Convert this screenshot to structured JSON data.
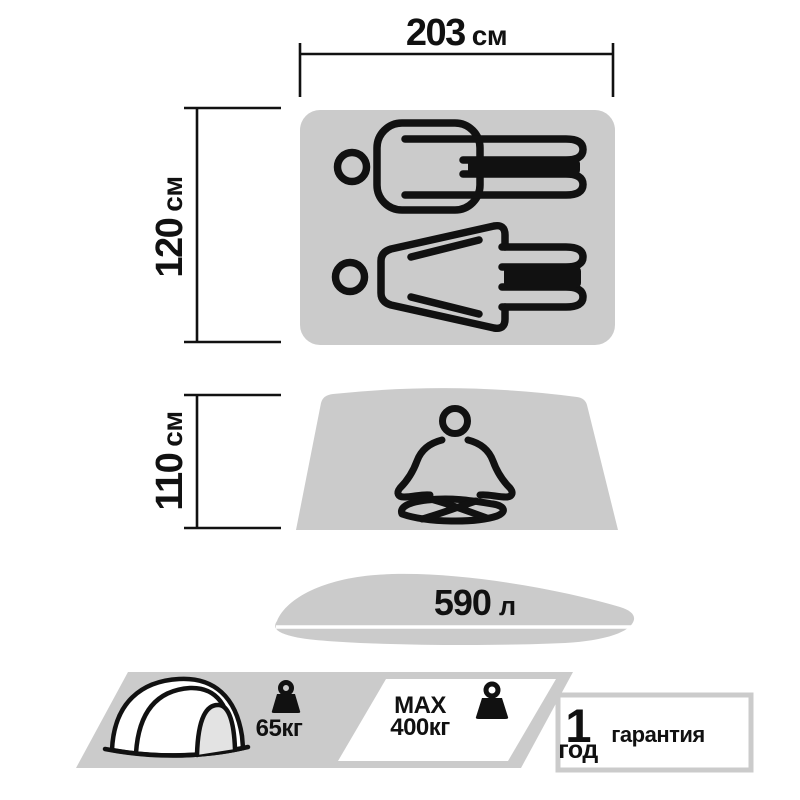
{
  "colors": {
    "shape_gray": "#cbcbcb",
    "ink": "#111111",
    "background": "#ffffff",
    "door_gray": "#e3e3e3"
  },
  "sleeping_area": {
    "width": {
      "value": "203",
      "unit": "см"
    },
    "height": {
      "value": "120",
      "unit": "см"
    },
    "icons": [
      "man-lying-icon",
      "woman-lying-icon"
    ]
  },
  "headroom": {
    "height": {
      "value": "110",
      "unit": "см"
    },
    "icon": "meditating-person-icon"
  },
  "volume": {
    "value": "590",
    "unit": "л"
  },
  "footer": {
    "tent_weight": {
      "value": "65кг",
      "icon": "weight-icon"
    },
    "max_load": {
      "line1": "MAX",
      "line2": "400кг",
      "icon": "weight-icon"
    },
    "warranty": {
      "value": "1",
      "period": "год",
      "label": "гарантия"
    }
  }
}
